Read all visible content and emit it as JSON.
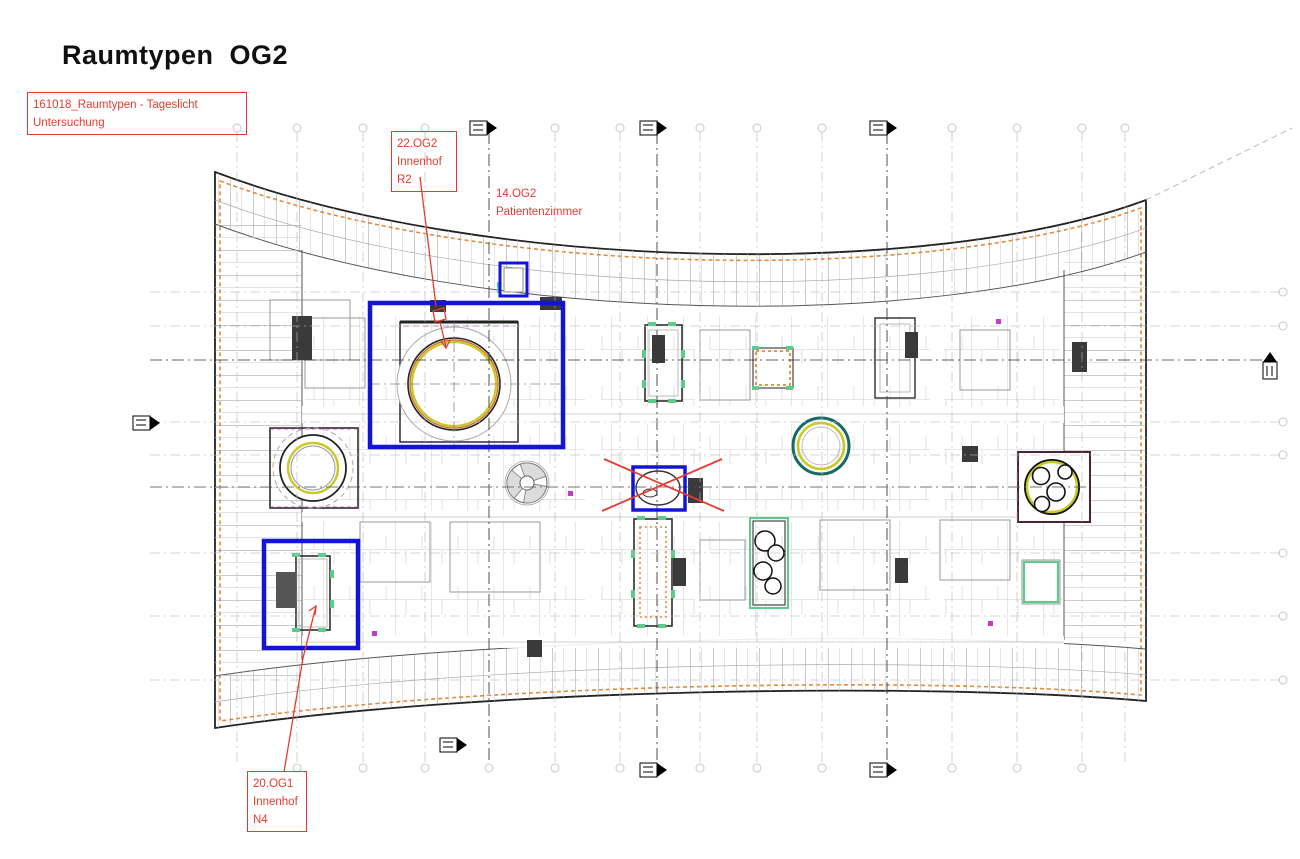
{
  "page": {
    "title": "Raumtypen  OG2"
  },
  "annotations": {
    "note": {
      "text": "161018_Raumtypen - Tageslicht\nUntersuchung"
    },
    "innenhof_r2": {
      "text": "22.OG2\nInnenhof\nR2"
    },
    "patientenzimmer": {
      "text": "14.OG2\nPatientenzimmer"
    },
    "innenhof_n4": {
      "text": "20.OG1\nInnenhof\nN4"
    }
  },
  "colors": {
    "annotation_red": "#e83a30",
    "highlight_blue": "#1414d6",
    "perimeter_orange": "#e08a3a",
    "ring_yellow": "#c9c926",
    "ring_teal": "#176a64",
    "accent_green": "#5ecb8c",
    "wall_dark": "#2d2d2d",
    "line_light": "#c4c4c4",
    "grid_gray": "#b9b9b9"
  }
}
